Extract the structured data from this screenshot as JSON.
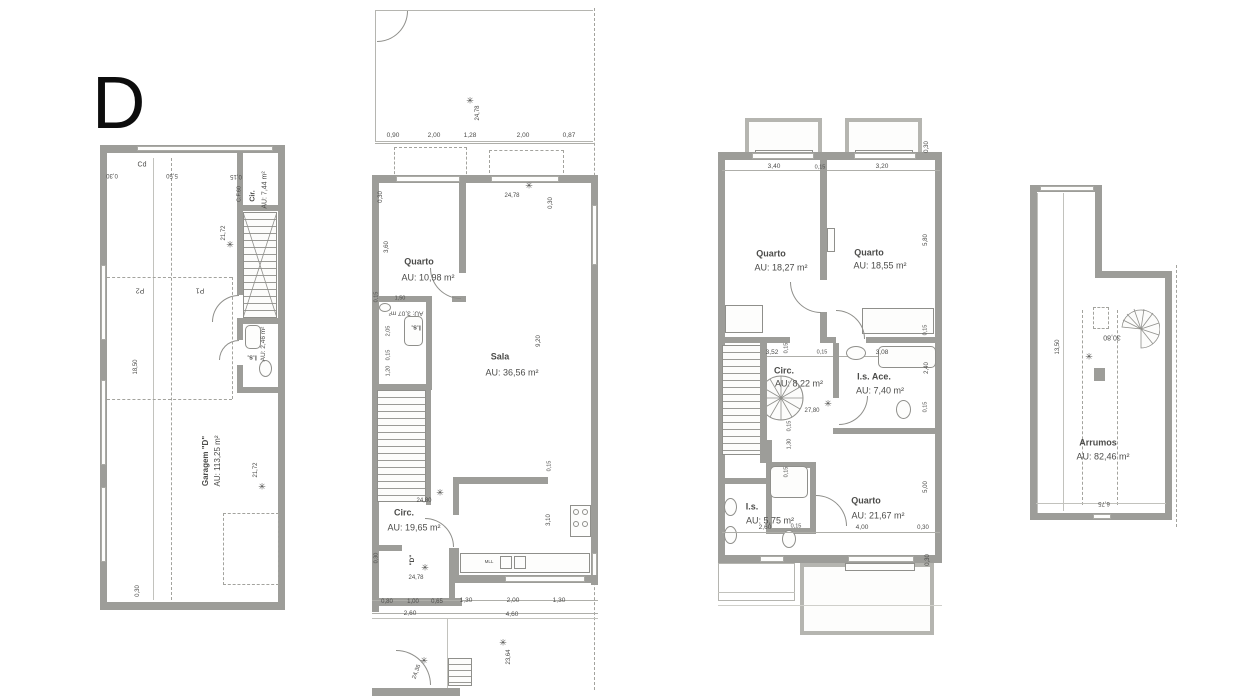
{
  "title": "D",
  "colors": {
    "wall_gray": "#9d9d99",
    "line_gray": "#8f8f8b",
    "light_wall": "#b8b8b3",
    "text_gray": "#4c4c4a",
    "background": "#ffffff"
  },
  "icons": {
    "level_marker": "✳"
  },
  "plans": [
    {
      "id": "garage-floor-plan",
      "rooms": [
        {
          "name": "Garagem \"D\"",
          "area": "AU: 113,25 m²"
        },
        {
          "name": "Cir.",
          "area": "AU: 7,44 m²"
        },
        {
          "name": "I.s.",
          "area": "AU: 2,46 m²"
        }
      ],
      "labels": [
        {
          "t": "Cd",
          "x": 142,
          "y": 165,
          "s": 7
        },
        {
          "t": "0,30",
          "x": 112,
          "y": 175,
          "r": 180,
          "s": 6
        },
        {
          "t": "5,50",
          "x": 172,
          "y": 175,
          "r": 180,
          "s": 6
        },
        {
          "t": "0,15",
          "x": 236,
          "y": 176,
          "r": 180,
          "s": 6
        },
        {
          "t": "C.F.60",
          "x": 240,
          "y": 194,
          "r": -90,
          "s": 5.5
        },
        {
          "t": "Cir.",
          "x": 253,
          "y": 196,
          "r": -90,
          "s": 7,
          "w": 1
        },
        {
          "t": "AU: 7,44 m²",
          "x": 265,
          "y": 190,
          "r": -90,
          "s": 7
        },
        {
          "t": "21,72",
          "x": 224,
          "y": 233,
          "r": -90,
          "s": 6
        },
        {
          "ic": "level_marker",
          "x": 230,
          "y": 245,
          "s": 9
        },
        {
          "t": "P2",
          "x": 140,
          "y": 290,
          "r": 180,
          "s": 7
        },
        {
          "t": "P1",
          "x": 200,
          "y": 290,
          "r": 180,
          "s": 7
        },
        {
          "t": "18,50",
          "x": 136,
          "y": 367,
          "r": -90,
          "s": 6
        },
        {
          "t": "I.s.",
          "x": 252,
          "y": 357,
          "r": 180,
          "s": 7,
          "w": 1
        },
        {
          "t": "AU: 2,46 m²",
          "x": 264,
          "y": 344,
          "r": -90,
          "s": 6.5
        },
        {
          "t": "Garagem \"D\"",
          "x": 206,
          "y": 461,
          "r": -90,
          "s": 8,
          "w": 1
        },
        {
          "t": "AU: 113,25 m²",
          "x": 218,
          "y": 461,
          "r": -90,
          "s": 8
        },
        {
          "t": "21,72",
          "x": 256,
          "y": 470,
          "r": -90,
          "s": 6
        },
        {
          "ic": "level_marker",
          "x": 262,
          "y": 487,
          "s": 9
        },
        {
          "t": "0,30",
          "x": 138,
          "y": 591,
          "r": -90,
          "s": 6
        }
      ]
    },
    {
      "id": "ground-floor-plan",
      "rooms": [
        {
          "name": "Quarto",
          "area": "AU: 10,98 m²"
        },
        {
          "name": "I.s.",
          "area": "AU: 3,07 m²"
        },
        {
          "name": "Sala",
          "area": "AU: 36,56 m²"
        },
        {
          "name": "Circ.",
          "area": "AU: 19,65 m²"
        },
        {
          "name": "Cozinha",
          "area": "AU: 12,40 m²"
        }
      ],
      "labels": [
        {
          "ic": "level_marker",
          "x": 470,
          "y": 101,
          "s": 9
        },
        {
          "t": "24,78",
          "x": 478,
          "y": 113,
          "r": -90,
          "s": 6
        },
        {
          "t": "0,90",
          "x": 393,
          "y": 136,
          "s": 6.5
        },
        {
          "t": "2,00",
          "x": 434,
          "y": 136,
          "s": 6.5
        },
        {
          "t": "1,28",
          "x": 470,
          "y": 136,
          "s": 6.5
        },
        {
          "t": "2,00",
          "x": 523,
          "y": 136,
          "s": 6.5
        },
        {
          "t": "0,87",
          "x": 569,
          "y": 136,
          "s": 6.5
        },
        {
          "ic": "level_marker",
          "x": 529,
          "y": 186,
          "s": 9
        },
        {
          "t": "24,78",
          "x": 512,
          "y": 196,
          "s": 6
        },
        {
          "t": "0,30",
          "x": 551,
          "y": 203,
          "r": -90,
          "s": 6
        },
        {
          "t": "0,30",
          "x": 381,
          "y": 197,
          "r": -90,
          "s": 6
        },
        {
          "t": "3,60",
          "x": 387,
          "y": 247,
          "r": -90,
          "s": 6
        },
        {
          "t": "Quarto",
          "x": 419,
          "y": 262,
          "s": 9,
          "w": 1
        },
        {
          "t": "AU: 10,98 m²",
          "x": 428,
          "y": 278,
          "s": 9
        },
        {
          "t": "0,15",
          "x": 377,
          "y": 297,
          "r": -90,
          "s": 5.5
        },
        {
          "t": "1,50",
          "x": 400,
          "y": 299,
          "s": 5.5
        },
        {
          "t": "AU: 3,07 m²",
          "x": 406,
          "y": 312,
          "r": 180,
          "s": 6.5
        },
        {
          "t": "I.s.",
          "x": 416,
          "y": 327,
          "r": 180,
          "s": 7,
          "w": 1
        },
        {
          "t": "2,05",
          "x": 389,
          "y": 331,
          "r": -90,
          "s": 5.5
        },
        {
          "t": "0,15",
          "x": 389,
          "y": 355,
          "r": -90,
          "s": 5.5
        },
        {
          "t": "1,20",
          "x": 389,
          "y": 371,
          "r": -90,
          "s": 5.5
        },
        {
          "t": "Sala",
          "x": 500,
          "y": 357,
          "s": 9,
          "w": 1
        },
        {
          "t": "AU: 36,56 m²",
          "x": 512,
          "y": 373,
          "s": 9
        },
        {
          "t": "9,20",
          "x": 539,
          "y": 341,
          "r": -90,
          "s": 6
        },
        {
          "t": "24,80",
          "x": 424,
          "y": 501,
          "s": 6
        },
        {
          "ic": "level_marker",
          "x": 440,
          "y": 493,
          "s": 9
        },
        {
          "t": "Circ.",
          "x": 404,
          "y": 513,
          "s": 9,
          "w": 1
        },
        {
          "t": "AU: 19,65 m²",
          "x": 414,
          "y": 528,
          "s": 9
        },
        {
          "t": "0,30",
          "x": 377,
          "y": 558,
          "r": -90,
          "s": 5.5
        },
        {
          "t": "\"D\"",
          "x": 413,
          "y": 560,
          "r": -90,
          "s": 6.5,
          "w": 1
        },
        {
          "ic": "level_marker",
          "x": 425,
          "y": 568,
          "s": 9
        },
        {
          "t": "24,78",
          "x": 416,
          "y": 578,
          "s": 6
        },
        {
          "t": "MLL",
          "x": 489,
          "y": 562,
          "s": 4.5
        },
        {
          "t": "0,15",
          "x": 550,
          "y": 466,
          "r": -90,
          "s": 5.5
        },
        {
          "t": "3,10",
          "x": 549,
          "y": 520,
          "r": -90,
          "s": 6
        },
        {
          "t": "0,80",
          "x": 387,
          "y": 602,
          "s": 6
        },
        {
          "t": "1,00",
          "x": 413,
          "y": 602,
          "s": 6
        },
        {
          "t": "0,65",
          "x": 437,
          "y": 602,
          "s": 6
        },
        {
          "t": "1,30",
          "x": 466,
          "y": 601,
          "s": 6.5
        },
        {
          "t": "2,00",
          "x": 513,
          "y": 601,
          "s": 6.5
        },
        {
          "t": "1,30",
          "x": 559,
          "y": 601,
          "s": 6.5
        },
        {
          "t": "2,60",
          "x": 410,
          "y": 614,
          "s": 6.5
        },
        {
          "t": "4,60",
          "x": 512,
          "y": 615,
          "s": 6.5
        },
        {
          "ic": "level_marker",
          "x": 424,
          "y": 661,
          "s": 9
        },
        {
          "t": "24,36",
          "x": 417,
          "y": 672,
          "r": -70,
          "s": 6
        },
        {
          "ic": "level_marker",
          "x": 503,
          "y": 643,
          "s": 9
        },
        {
          "t": "23,64",
          "x": 509,
          "y": 657,
          "r": -90,
          "s": 6
        }
      ]
    },
    {
      "id": "first-floor-plan",
      "rooms": [
        {
          "name": "Quarto",
          "area": "AU: 18,27 m²"
        },
        {
          "name": "Quarto",
          "area": "AU: 18,55 m²"
        },
        {
          "name": "Circ.",
          "area": "AU: 8,22 m²"
        },
        {
          "name": "I.s. Ace.",
          "area": "AU: 7,40 m²"
        },
        {
          "name": "I.s.",
          "area": "AU: 5,75 m²"
        },
        {
          "name": "Quarto",
          "area": "AU: 21,67 m²"
        }
      ],
      "labels": [
        {
          "t": "3,40",
          "x": 774,
          "y": 167,
          "s": 6.5
        },
        {
          "t": "0,15",
          "x": 820,
          "y": 168,
          "s": 5.5
        },
        {
          "t": "3,20",
          "x": 882,
          "y": 167,
          "s": 6.5
        },
        {
          "t": "0,30",
          "x": 927,
          "y": 147,
          "r": -90,
          "s": 6
        },
        {
          "t": "5,80",
          "x": 926,
          "y": 240,
          "r": -90,
          "s": 6
        },
        {
          "t": "Quarto",
          "x": 771,
          "y": 254,
          "s": 9,
          "w": 1
        },
        {
          "t": "AU: 18,27 m²",
          "x": 781,
          "y": 268,
          "s": 9
        },
        {
          "t": "Quarto",
          "x": 869,
          "y": 253,
          "s": 9,
          "w": 1
        },
        {
          "t": "AU: 18,55 m²",
          "x": 880,
          "y": 266,
          "s": 9
        },
        {
          "t": "0,15",
          "x": 926,
          "y": 330,
          "r": -90,
          "s": 5.5
        },
        {
          "t": "3,52",
          "x": 772,
          "y": 353,
          "s": 6.5
        },
        {
          "t": "0,15",
          "x": 787,
          "y": 348,
          "r": -90,
          "s": 5.5
        },
        {
          "t": "0,15",
          "x": 822,
          "y": 353,
          "s": 5.5
        },
        {
          "t": "3,08",
          "x": 882,
          "y": 353,
          "s": 6.5
        },
        {
          "t": "2,40",
          "x": 927,
          "y": 368,
          "r": -90,
          "s": 6
        },
        {
          "t": "Circ.",
          "x": 784,
          "y": 371,
          "s": 9,
          "w": 1
        },
        {
          "t": "AU: 8,22 m²",
          "x": 799,
          "y": 384,
          "s": 9
        },
        {
          "t": "I.s. Ace.",
          "x": 874,
          "y": 377,
          "s": 9,
          "w": 1
        },
        {
          "t": "AU: 7,40 m²",
          "x": 880,
          "y": 391,
          "s": 9
        },
        {
          "t": "27,80",
          "x": 812,
          "y": 411,
          "s": 6
        },
        {
          "ic": "level_marker",
          "x": 828,
          "y": 404,
          "s": 9
        },
        {
          "t": "0,15",
          "x": 926,
          "y": 407,
          "r": -90,
          "s": 5.5
        },
        {
          "t": "0,15",
          "x": 790,
          "y": 426,
          "r": -90,
          "s": 5.5
        },
        {
          "t": "1,30",
          "x": 790,
          "y": 444,
          "r": -90,
          "s": 5.5
        },
        {
          "t": "0,15",
          "x": 787,
          "y": 472,
          "r": -90,
          "s": 5.5
        },
        {
          "t": "I.s.",
          "x": 752,
          "y": 507,
          "s": 9,
          "w": 1
        },
        {
          "t": "AU: 5,75 m²",
          "x": 770,
          "y": 521,
          "s": 9
        },
        {
          "t": "Quarto",
          "x": 866,
          "y": 501,
          "s": 9,
          "w": 1
        },
        {
          "t": "AU: 21,67 m²",
          "x": 878,
          "y": 516,
          "s": 9
        },
        {
          "t": "2,60",
          "x": 765,
          "y": 528,
          "s": 6.5
        },
        {
          "t": "0,15",
          "x": 796,
          "y": 527,
          "s": 5.5
        },
        {
          "t": "4,00",
          "x": 862,
          "y": 528,
          "s": 6.5
        },
        {
          "t": "0,30",
          "x": 923,
          "y": 528,
          "s": 6
        },
        {
          "t": "5,00",
          "x": 926,
          "y": 487,
          "r": -90,
          "s": 6
        },
        {
          "t": "0,30",
          "x": 928,
          "y": 560,
          "r": -90,
          "s": 6
        }
      ]
    },
    {
      "id": "attic-floor-plan",
      "rooms": [
        {
          "name": "Arrumos",
          "area": "AU: 82,46 m²"
        }
      ],
      "labels": [
        {
          "t": "13,50",
          "x": 1058,
          "y": 347,
          "r": -90,
          "s": 6
        },
        {
          "t": "30,80",
          "x": 1112,
          "y": 337,
          "r": 180,
          "s": 7
        },
        {
          "ic": "level_marker",
          "x": 1089,
          "y": 357,
          "s": 9
        },
        {
          "t": "Arrumos",
          "x": 1098,
          "y": 443,
          "s": 9,
          "w": 1
        },
        {
          "t": "AU: 82,46 m²",
          "x": 1103,
          "y": 457,
          "s": 9
        },
        {
          "t": "6,75",
          "x": 1104,
          "y": 503,
          "r": 180,
          "s": 6
        }
      ]
    }
  ]
}
